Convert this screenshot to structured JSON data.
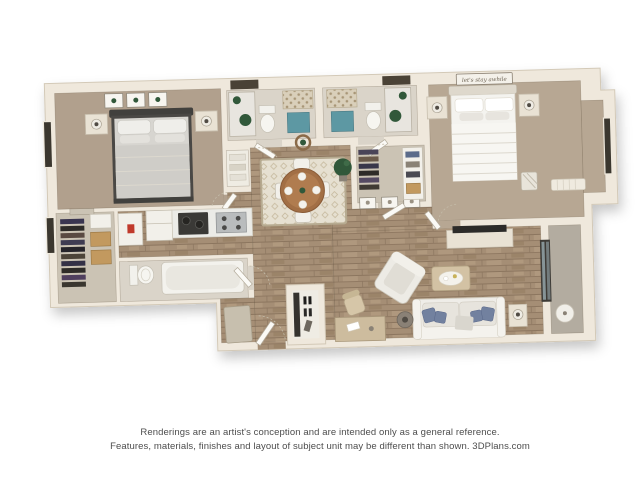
{
  "disclaimer": {
    "line1": "Renderings are an artist's conception and are intended only as a general reference.",
    "line2": "Features, materials, finishes and layout of subject unit may be different than shown. 3DPlans.com"
  },
  "decor": {
    "bed_sign_text": "let's stay awhile"
  },
  "palette": {
    "background": "#ffffff",
    "wall": "#efe8dc",
    "wall_edge": "#d3c9b7",
    "carpet_bedroom1": "#b1a08d",
    "carpet_bedroom2": "#b7a793",
    "wood_floor": "#a58e75",
    "tile_floor": "#dad4c9",
    "closet_floor": "#cbc3b4",
    "balcony_floor": "#b3aca0",
    "shower_mat_teal": "#5d98a3",
    "pillow_blue": "#72819f",
    "dining_table_wood": "#a26f45",
    "rug": "#e6e0d1",
    "plant_green": "#31583a",
    "basket_tan": "#c2995f",
    "appliance_dark": "#3a3936",
    "water_heater_label_red": "#c0392b",
    "text_gray": "#4d4d4d"
  }
}
